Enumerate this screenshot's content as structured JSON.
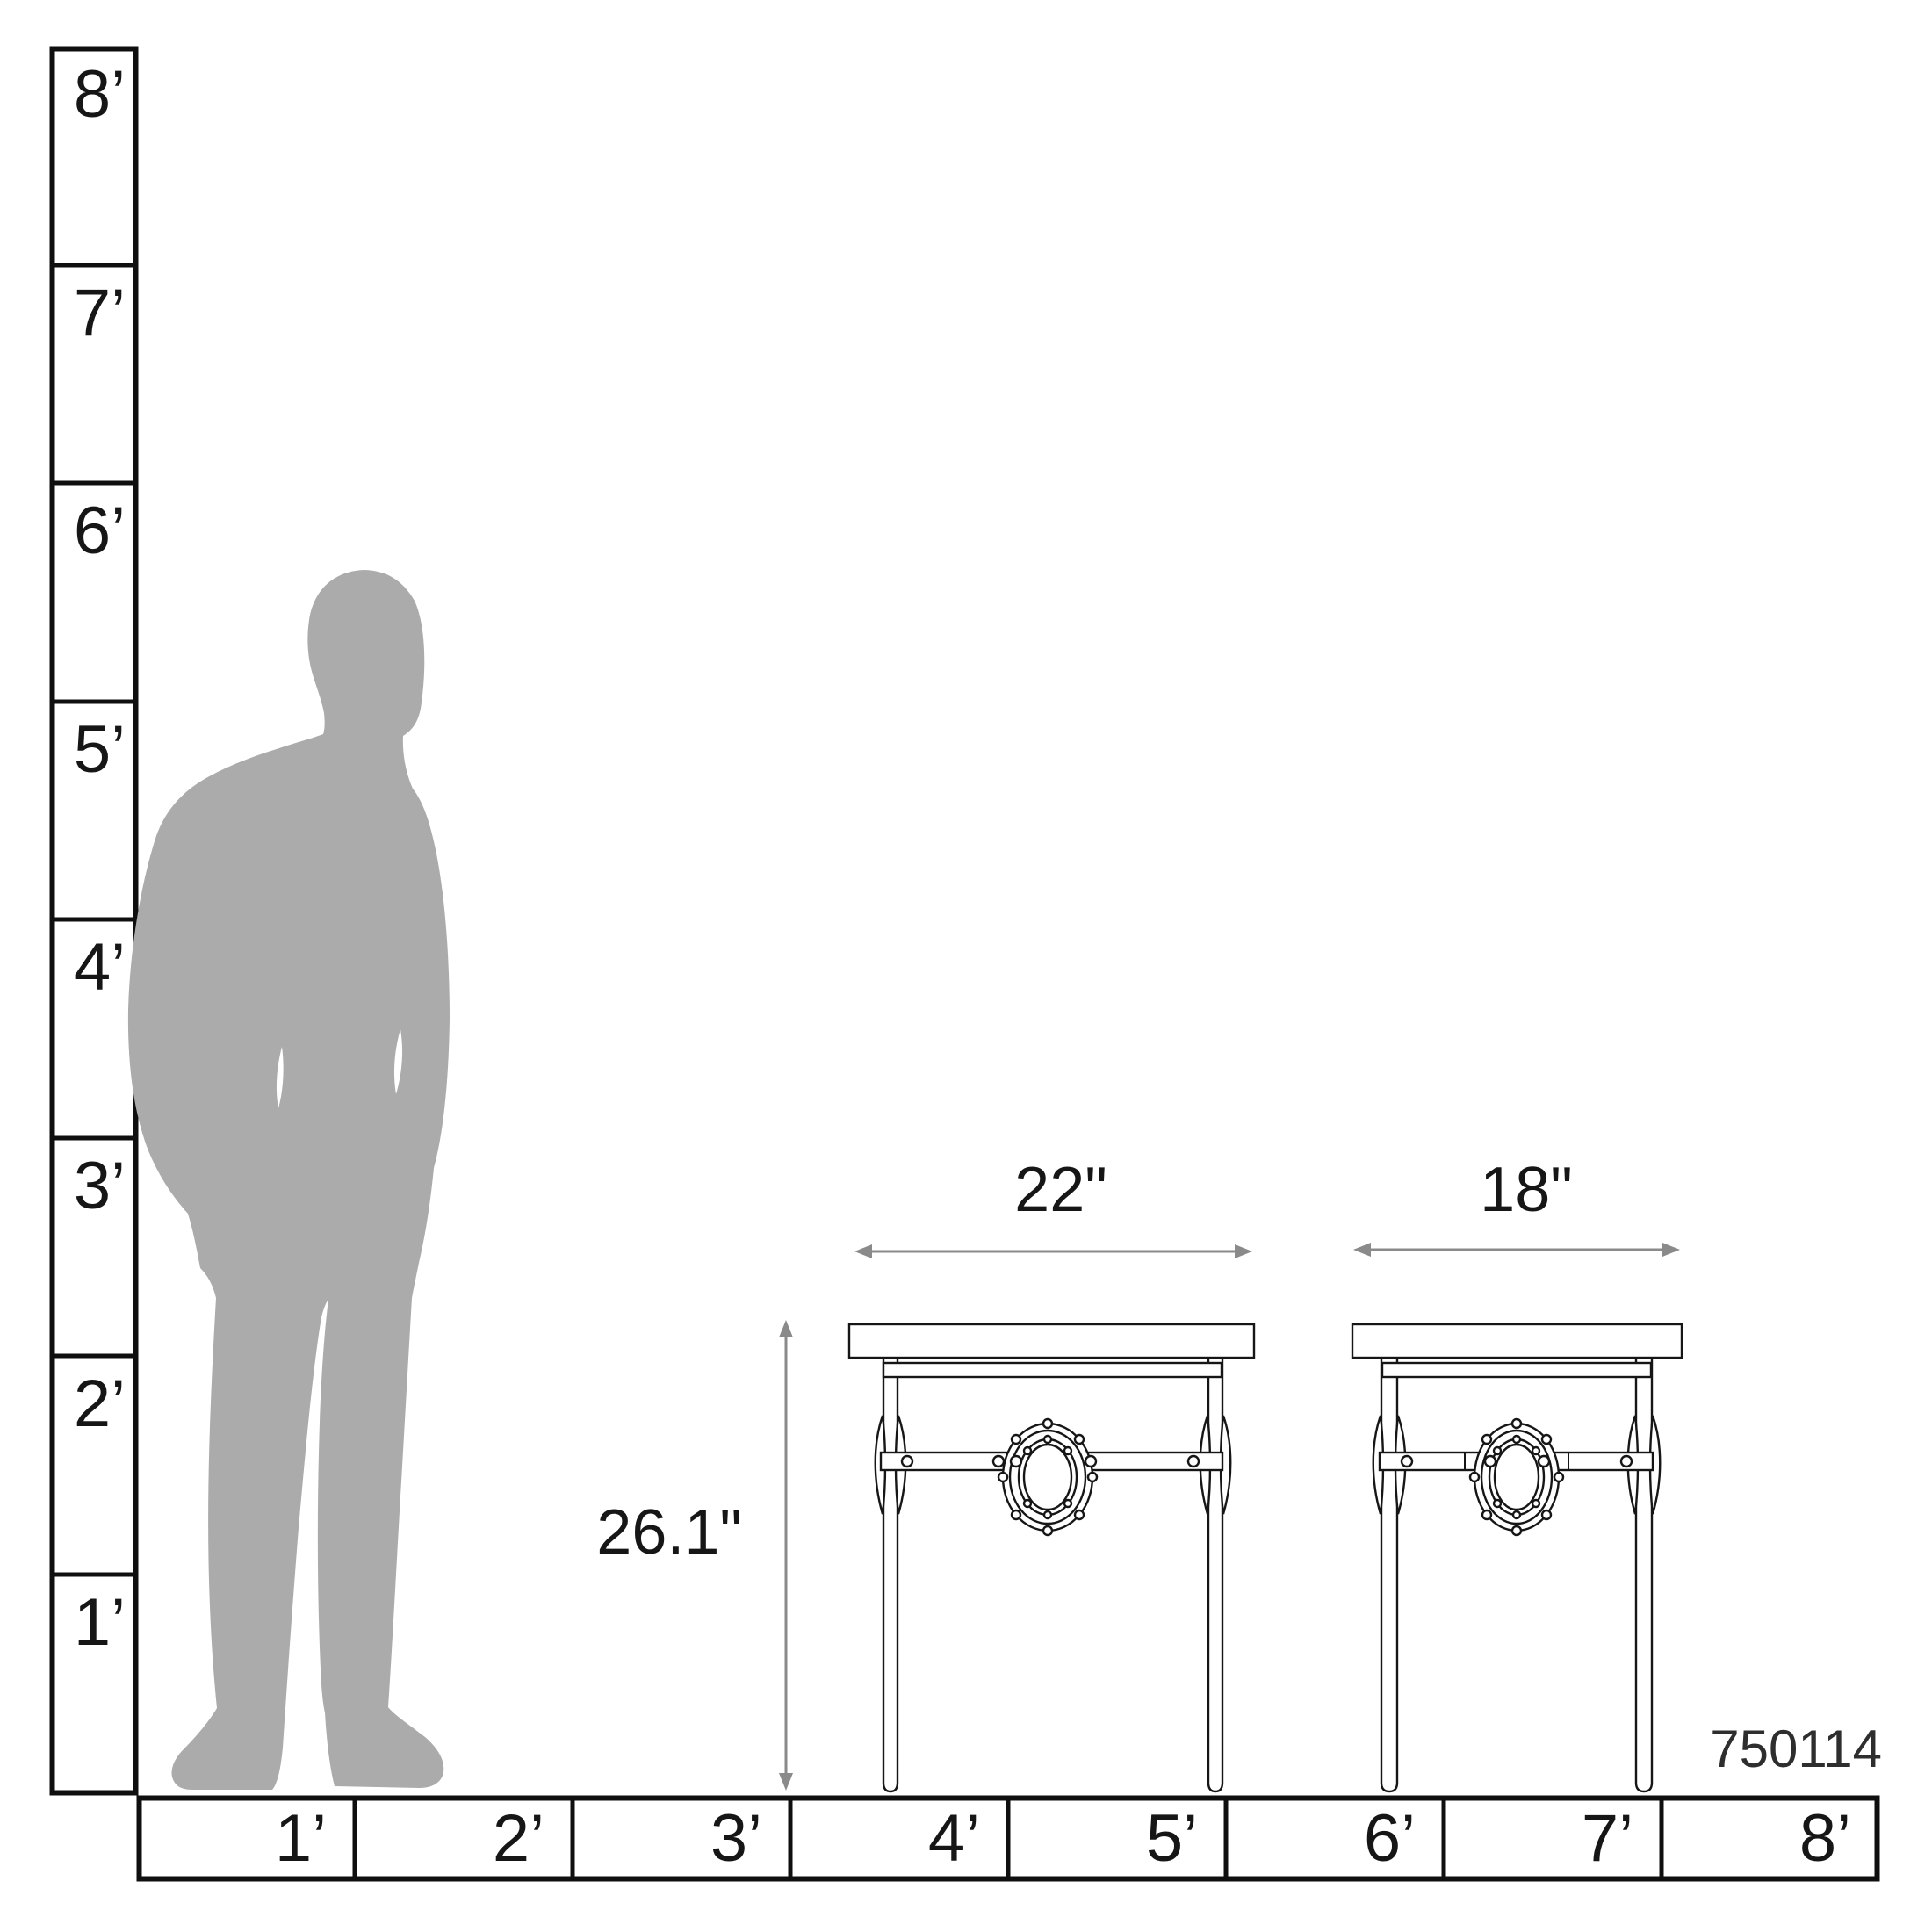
{
  "diagram": {
    "description": "Furniture scale diagram: man silhouette with two side tables against foot rulers",
    "product_code": "750114"
  },
  "vertical_ruler": {
    "unit": "feet",
    "labels": [
      "8’",
      "7’",
      "6’",
      "5’",
      "4’",
      "3’",
      "2’",
      "1’"
    ]
  },
  "horizontal_ruler": {
    "unit": "feet",
    "labels": [
      "1’",
      "2’",
      "3’",
      "4’",
      "5’",
      "6’",
      "7’",
      "8’"
    ]
  },
  "annotations": {
    "left_table_width": "22\"",
    "right_table_width": "18\"",
    "table_height": "26.1\""
  },
  "colors": {
    "line": "#0f0f0f",
    "table_line": "#161616",
    "arrow": "#8a8a8a",
    "silhouette": "#ababab",
    "text": "#161616",
    "background": "#ffffff"
  }
}
